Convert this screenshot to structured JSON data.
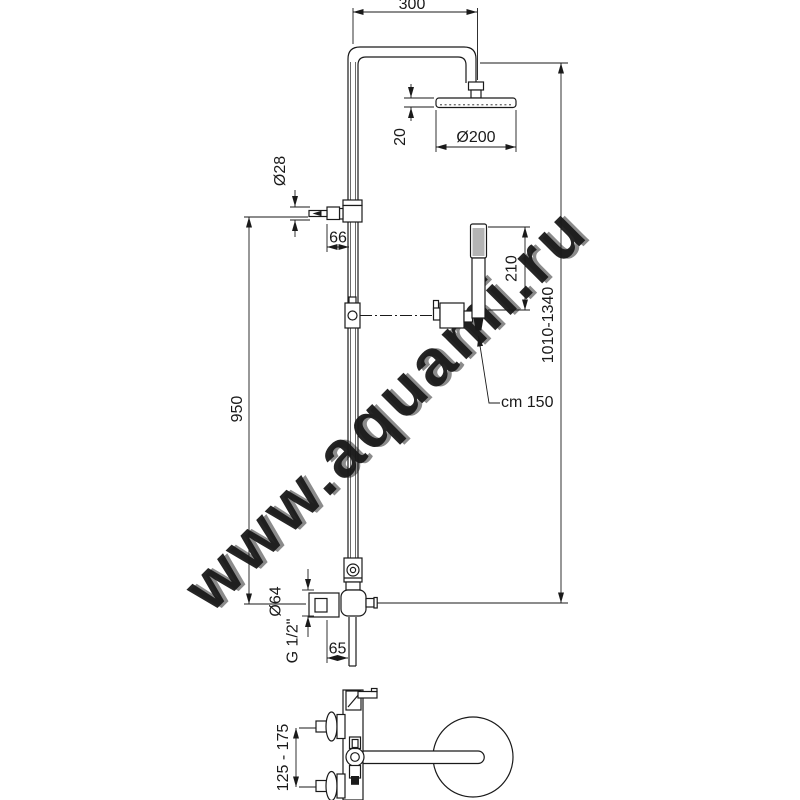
{
  "watermark": {
    "text": "www.aquami.ru"
  },
  "dimensions": {
    "arm_reach": "300",
    "head_thickness": "20",
    "head_diameter": "Ø200",
    "diverter_diameter": "Ø28",
    "diverter_offset": "66",
    "handshower_length": "210",
    "column_height_range": "1010-1340",
    "riser_height": "950",
    "hose_length": "cm 150",
    "mixer_diameter": "Ø64",
    "connection_thread": "G 1/2\"",
    "outlet_offset": "65",
    "wall_centers_range": "125 - 175"
  }
}
